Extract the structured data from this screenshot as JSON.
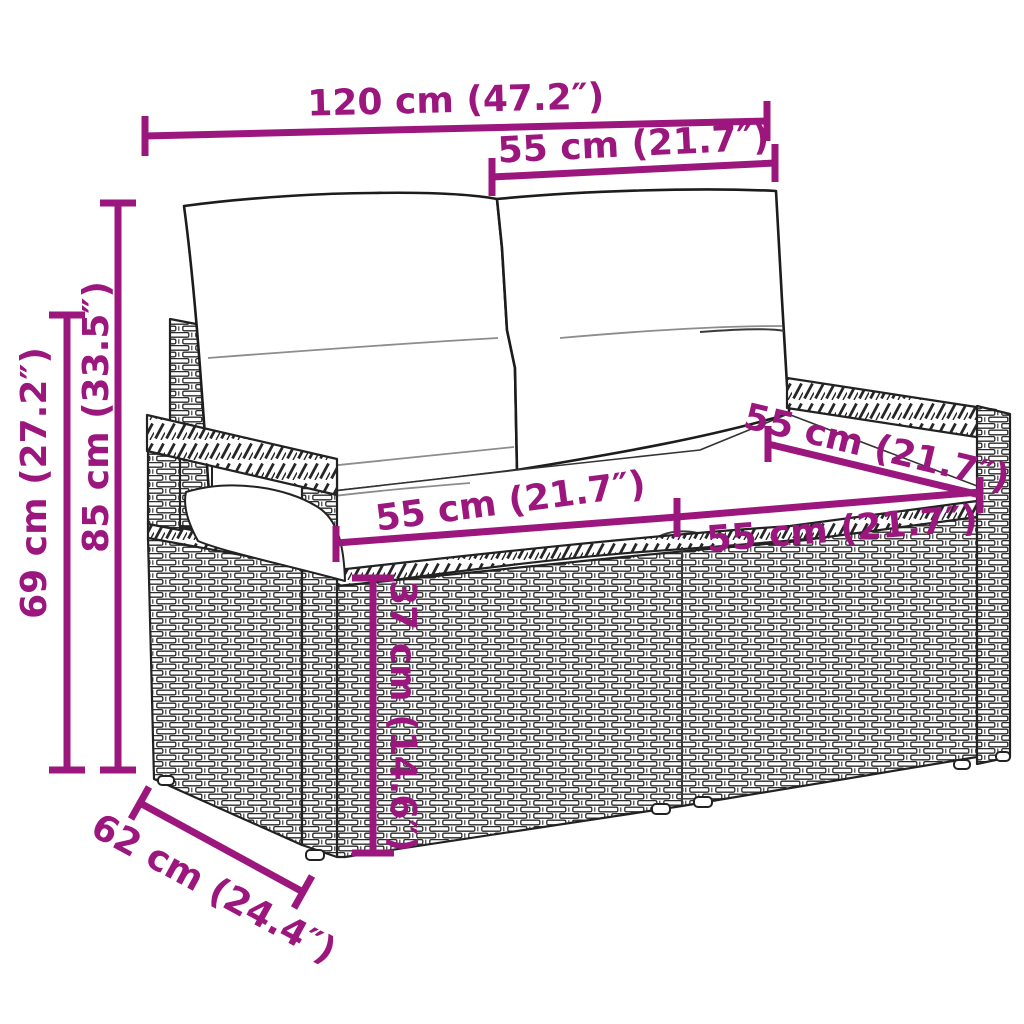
{
  "title": "Garden loveseat dimension diagram",
  "accent_color": "#9B177E",
  "dims": {
    "overall_width": {
      "label": "120 cm (47.2″)"
    },
    "backrest_width": {
      "label": "55 cm (21.7″)"
    },
    "total_height": {
      "label": "85 cm (33.5″)"
    },
    "armrest_height": {
      "label": "69 cm (27.2″)"
    },
    "seat_width_left": {
      "label": "55 cm (21.7″)"
    },
    "seat_width_right": {
      "label": "55 cm (21.7″)"
    },
    "seat_depth": {
      "label": "55 cm (21.7″)"
    },
    "seat_height": {
      "label": "37 cm (14.6″)"
    },
    "base_depth": {
      "label": "62 cm (24.4″)"
    }
  }
}
